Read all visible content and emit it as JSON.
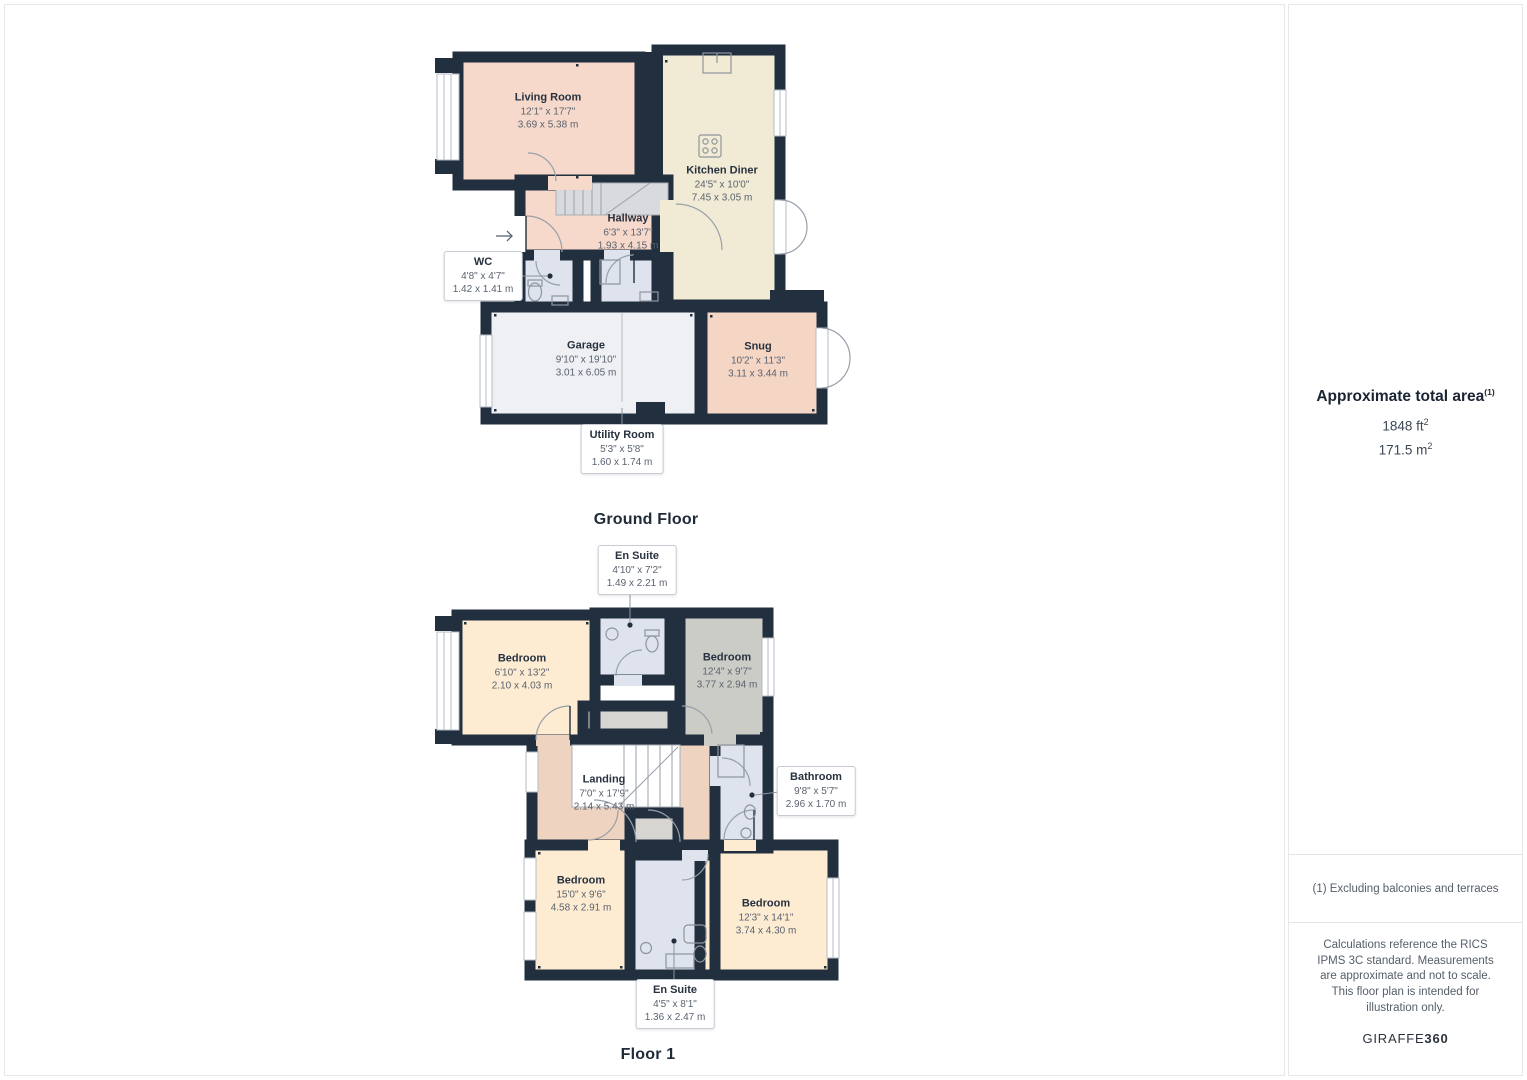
{
  "ground": {
    "title": "Ground Floor",
    "rooms": [
      {
        "name": "Living Room",
        "imperial": "12'1\" x 17'7\"",
        "metric": "3.69 x 5.38 m"
      },
      {
        "name": "Kitchen Diner",
        "imperial": "24'5\" x 10'0\"",
        "metric": "7.45 x 3.05 m"
      },
      {
        "name": "Hallway",
        "imperial": "6'3\" x 13'7\"",
        "metric": "1.93 x 4.15 m"
      },
      {
        "name": "WC",
        "imperial": "4'8\" x 4'7\"",
        "metric": "1.42 x 1.41 m"
      },
      {
        "name": "Garage",
        "imperial": "9'10\" x 19'10\"",
        "metric": "3.01 x 6.05 m"
      },
      {
        "name": "Snug",
        "imperial": "10'2\" x 11'3\"",
        "metric": "3.11 x 3.44 m"
      },
      {
        "name": "Utility Room",
        "imperial": "5'3\" x 5'8\"",
        "metric": "1.60 x 1.74 m"
      }
    ]
  },
  "floor1": {
    "title": "Floor 1",
    "rooms": [
      {
        "name": "En Suite",
        "imperial": "4'10\" x 7'2\"",
        "metric": "1.49 x 2.21 m"
      },
      {
        "name": "Bedroom",
        "imperial": "6'10\" x 13'2\"",
        "metric": "2.10 x 4.03 m"
      },
      {
        "name": "Bedroom",
        "imperial": "12'4\" x 9'7\"",
        "metric": "3.77 x 2.94 m"
      },
      {
        "name": "Landing",
        "imperial": "7'0\" x 17'9\"",
        "metric": "2.14 x 5.43 m"
      },
      {
        "name": "Bathroom",
        "imperial": "9'8\" x 5'7\"",
        "metric": "2.96 x 1.70 m"
      },
      {
        "name": "Bedroom",
        "imperial": "15'0\" x 9'6\"",
        "metric": "4.58 x 2.91 m"
      },
      {
        "name": "Bedroom",
        "imperial": "12'3\" x 14'1\"",
        "metric": "3.74 x 4.30 m"
      },
      {
        "name": "En Suite",
        "imperial": "4'5\" x 8'1\"",
        "metric": "1.36 x 2.47 m"
      }
    ]
  },
  "sidebar": {
    "area_heading": "Approximate total area",
    "area_heading_sup": "(1)",
    "area_ft": "1848 ft",
    "area_ft_sup": "2",
    "area_m": "171.5 m",
    "area_m_sup": "2",
    "footnote": "(1) Excluding balconies and terraces",
    "disclaimer": "Calculations reference the RICS IPMS 3C standard. Measurements are approximate and not to scale. This floor plan is intended for illustration only.",
    "brand_name": "GIRAFFE",
    "brand_suffix": "360"
  },
  "colors": {
    "wall": "#212f3f",
    "room_pink": "#f6d9ca",
    "room_tan": "#eed3c1",
    "room_cream": "#f1ead4",
    "room_blue": "#dee3ee",
    "room_gray": "#cbccc6",
    "room_garage": "#eef0f3",
    "stairs_gray": "#d8dadd"
  }
}
